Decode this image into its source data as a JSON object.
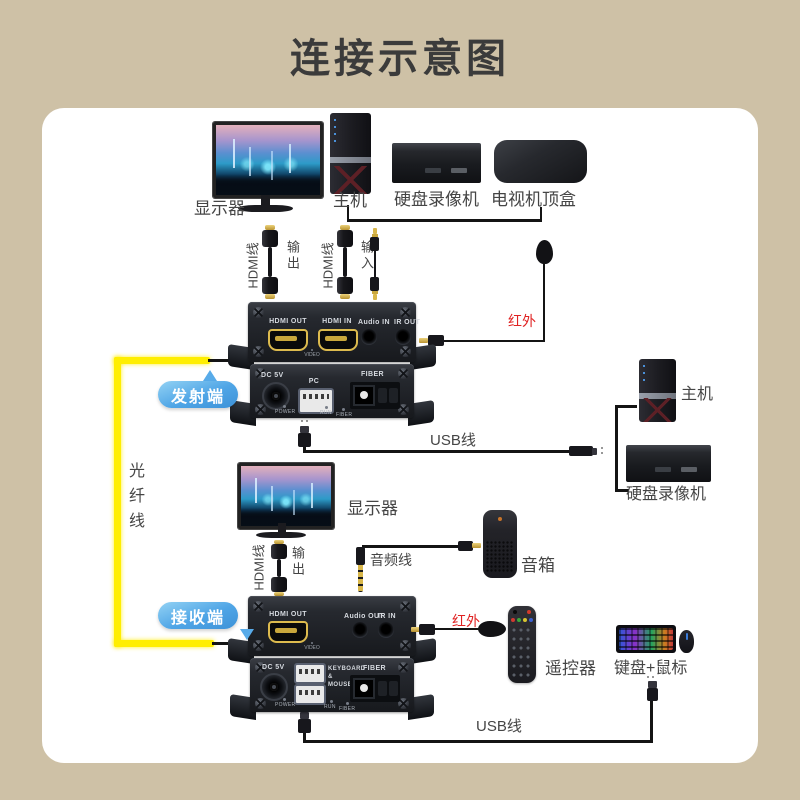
{
  "title": "连接示意图",
  "colors": {
    "background": "#cec1a6",
    "badge_blue": "#4fa5e6",
    "fiber_yellow": "#ffee00",
    "ir_red": "#e02222"
  },
  "top": {
    "monitor": "显示器",
    "pc": "主机",
    "dvr": "硬盘录像机",
    "stb": "电视机顶盒"
  },
  "cables": {
    "hdmi": "HDMI线",
    "out": "输出",
    "in": "输入",
    "usb": "USB线",
    "fiber": "光纤线",
    "audio": "音频线",
    "ir": "红外"
  },
  "tx": {
    "badge": "发射端",
    "hdmi_out": "HDMI OUT",
    "hdmi_in": "HDMI IN",
    "audio_in": "Audio IN",
    "ir_out": "IR OUT",
    "video": "VIDEO",
    "dc": "DC 5V",
    "pc": "PC",
    "fiber": "FIBER",
    "power": "POWER",
    "run": "RUN"
  },
  "rx": {
    "badge": "接收端",
    "hdmi_out": "HDMI OUT",
    "video": "VIDEO",
    "audio_out": "Audio OUT",
    "ir_in": "IR IN",
    "dc": "DC 5V",
    "kb1": "KEYBOARD",
    "kb2": "&",
    "kb3": "MOUSE",
    "fiber": "FIBER",
    "power": "POWER",
    "run": "RUN"
  },
  "right": {
    "pc": "主机",
    "dvr": "硬盘录像机"
  },
  "mid": {
    "monitor": "显示器",
    "speaker": "音箱"
  },
  "bottom": {
    "remote": "遥控器",
    "kbm": "键盘+鼠标"
  }
}
